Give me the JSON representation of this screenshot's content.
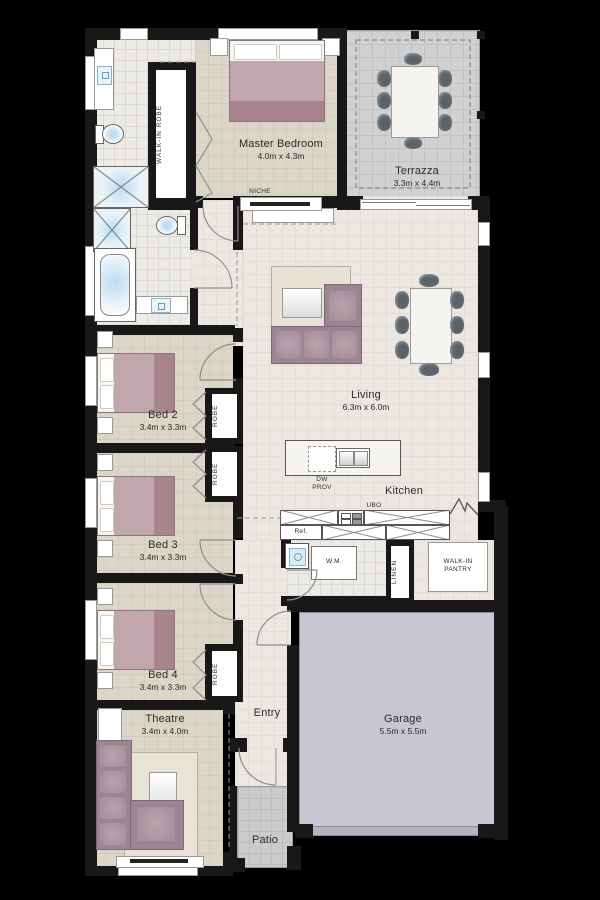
{
  "rooms": {
    "master": {
      "name": "Master Bedroom",
      "dims": "4.0m x 4.3m"
    },
    "terrazza": {
      "name": "Terrazza",
      "dims": "3.3m x 4.4m"
    },
    "living": {
      "name": "Living",
      "dims": "6.3m x 6.0m"
    },
    "kitchen": {
      "name": "Kitchen"
    },
    "bed2": {
      "name": "Bed 2",
      "dims": "3.4m x 3.3m"
    },
    "bed3": {
      "name": "Bed 3",
      "dims": "3.4m x 3.3m"
    },
    "bed4": {
      "name": "Bed 4",
      "dims": "3.4m x 3.3m"
    },
    "theatre": {
      "name": "Theatre",
      "dims": "3.4m x 4.0m"
    },
    "garage": {
      "name": "Garage",
      "dims": "5.5m x 5.5m"
    },
    "entry": {
      "name": "Entry"
    },
    "patio": {
      "name": "Patio"
    }
  },
  "fixtures": {
    "walk_in_robe": "WALK-IN ROBE",
    "robe": "ROBE",
    "niche": "NICHE",
    "linen": "LINEN",
    "pantry_l1": "WALK-IN",
    "pantry_l2": "PANTRY",
    "wm": "W.M.",
    "ref": "Ref.",
    "dw_l1": "DW",
    "dw_l2": "PROV",
    "ubo": "UBO"
  },
  "colors": {
    "background": "#000000",
    "wall": "#181818",
    "bedroom_floor": "#dcd6c9",
    "living_floor": "#ece8e1",
    "tile_floor": "#edebe6",
    "terrazza_floor": "#d1d1d1",
    "garage_floor": "#c9c5d3",
    "patio_floor": "#cbcbcb",
    "bed_accent": "#c2a6ae",
    "sofa_accent": "#9c8492",
    "chair": "#5a636a"
  }
}
